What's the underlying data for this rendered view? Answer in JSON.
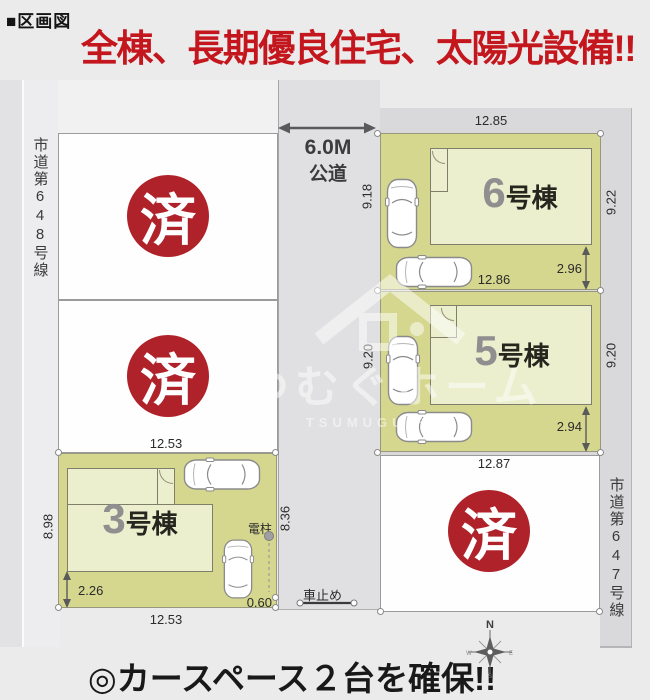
{
  "header": {
    "section_label": "■区画図",
    "headline": "全棟、長期優良住宅、太陽光設備!!"
  },
  "roads": {
    "left_name": "市道第648号線",
    "right_name": "市道第647号線",
    "front_width": "6.0M",
    "front_type": "公道"
  },
  "sold_stamp": "済",
  "units": {
    "u6": {
      "num": "6",
      "suffix": "号棟",
      "top": "12.85",
      "left": "9.18",
      "right": "9.22",
      "bottom": "12.86",
      "inner": "2.96"
    },
    "u5": {
      "num": "5",
      "suffix": "号棟",
      "left": "9.20",
      "right": "9.20",
      "bottom": "12.87",
      "inner": "2.94"
    },
    "u3": {
      "num": "3",
      "suffix": "号棟",
      "top": "12.53",
      "left": "8.98",
      "right": "8.36",
      "bottom": "12.53",
      "inner": "2.26",
      "corner": "0.60"
    }
  },
  "annotations": {
    "pole_label": "電柱",
    "car_stop_label": "車止め"
  },
  "compass": {
    "n": "N",
    "e": "E",
    "s": "S",
    "w": "W"
  },
  "watermark": {
    "jp": "つむぐホーム",
    "en": "TSUMUGU HOME"
  },
  "footer": {
    "caption": "◎カースペース２台を確保!!"
  },
  "colors": {
    "headline_red": "#c3161d",
    "stamp_red": "#b0222a",
    "lot_green": "#d5d78f",
    "building_green": "#ebefcd",
    "road_gray": "#d9d9db"
  }
}
